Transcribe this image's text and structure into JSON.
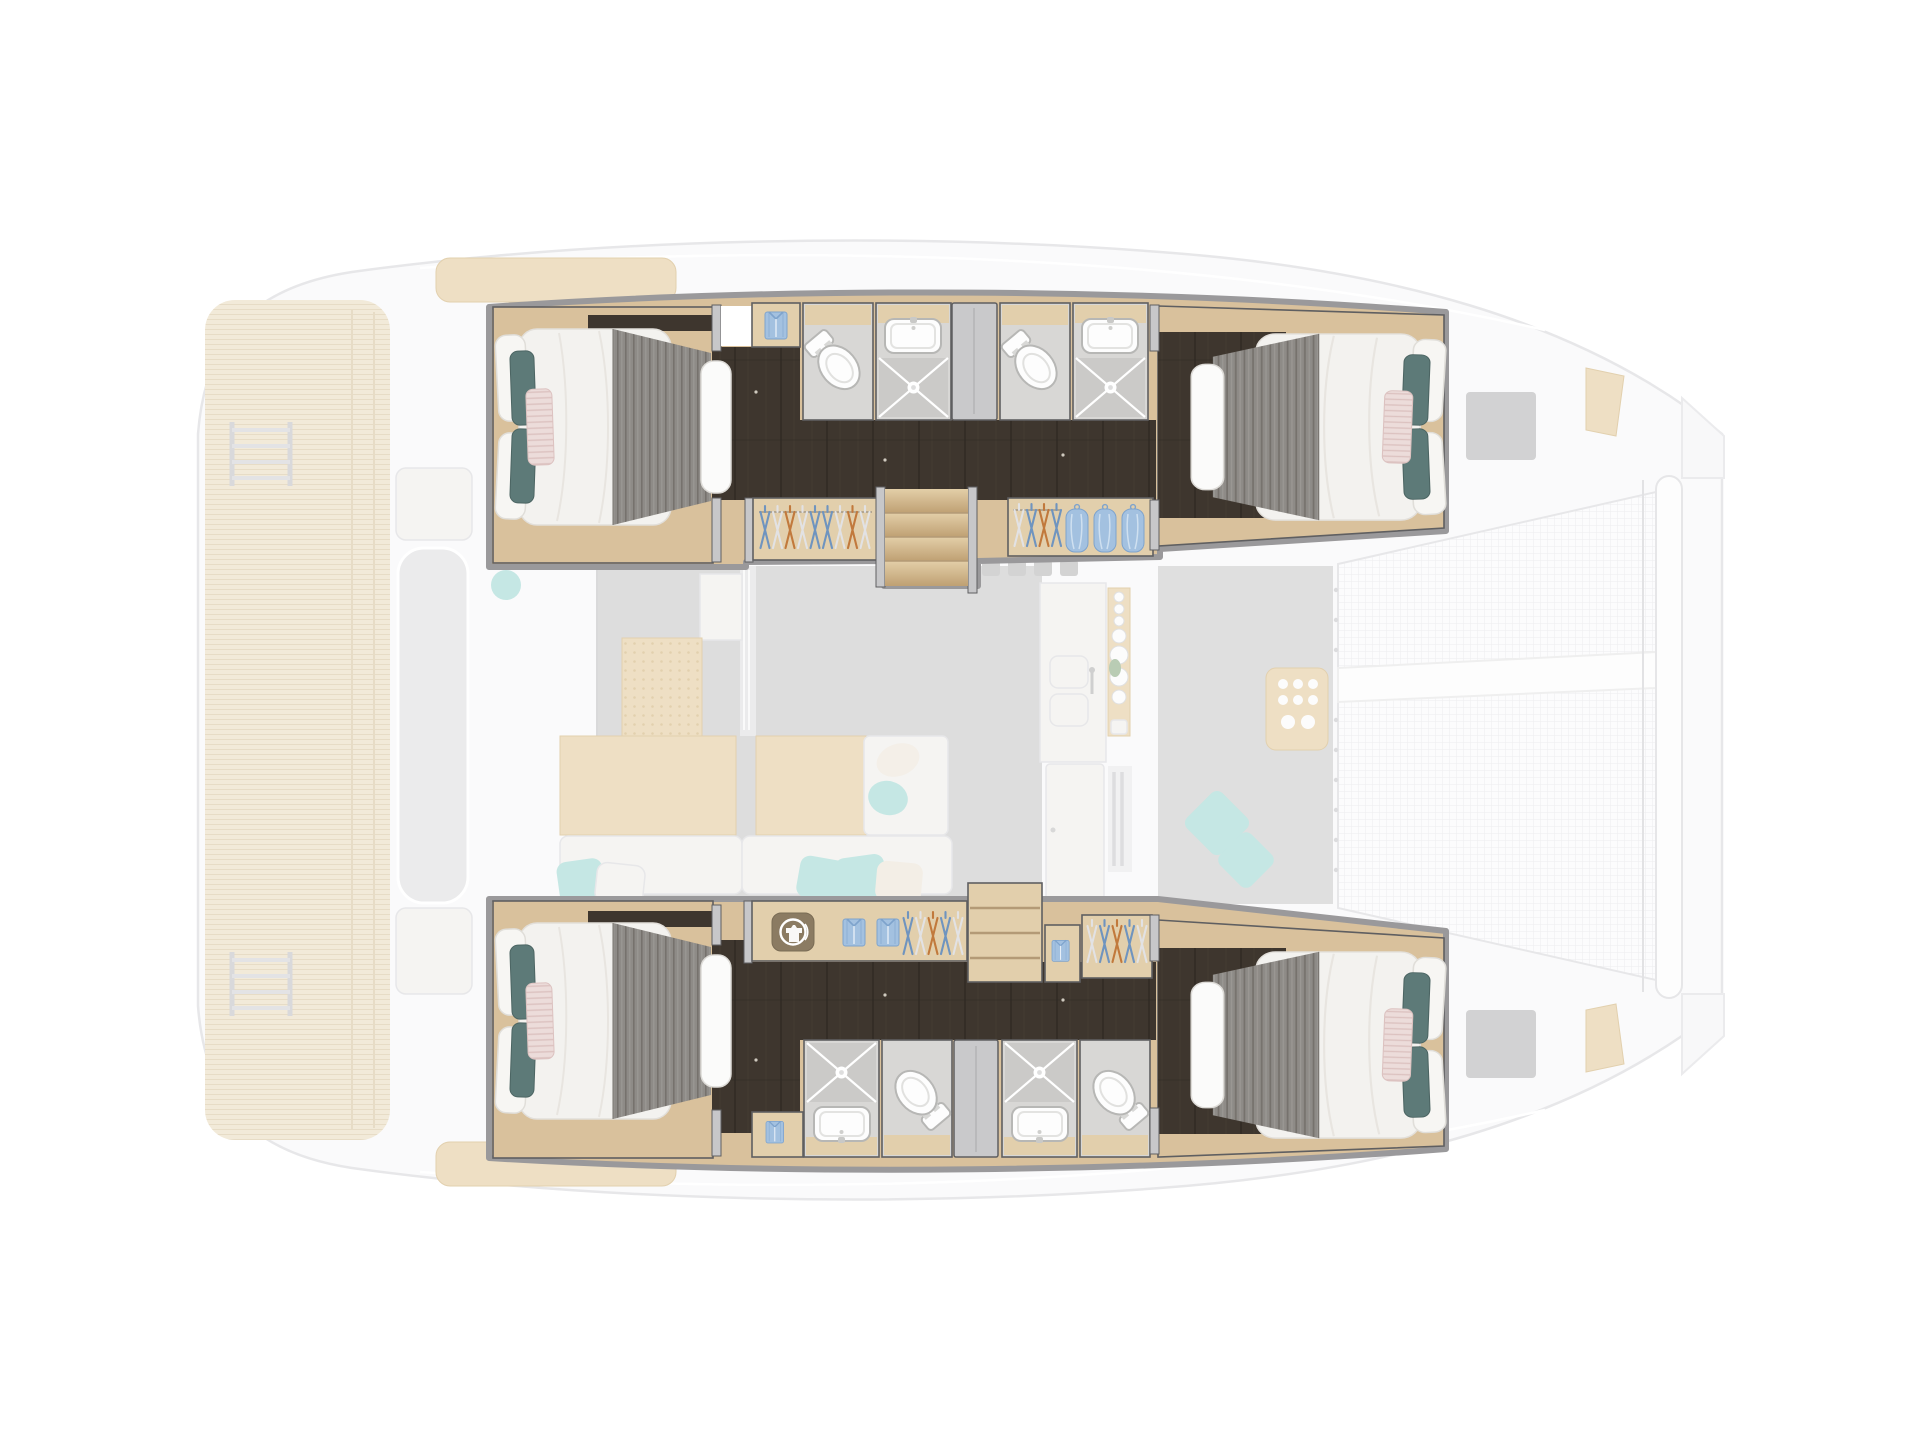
{
  "diagram": {
    "type": "yacht-floor-plan",
    "vessel": "sailing catamaran, top-down deck plan, bow to the right",
    "highlighted": "four hull double cabins, four head compartments with showers, wardrobes and companionway at full opacity",
    "ghosted": "aft swim platforms, cockpit, saloon, galley, forward cockpit, foredeck hatches and bow trampoline shown faded"
  },
  "counts": {
    "double_cabins": 4,
    "head_compartments": 4,
    "toilets": 4,
    "washbasins": 4,
    "shower_trays": 4,
    "wardrobes": 4,
    "folded_shirts": 5,
    "hanging_garments": 3,
    "companionway_steps": 4
  },
  "labels": {
    "plan": "Catamaran deck plan - four cabin layout",
    "port_hull": "Port hull accommodations (top)",
    "stbd_hull": "Starboard hull accommodations (bottom)",
    "port_aft_cabin": "Port aft double cabin, island bed head towards stern",
    "port_fwd_cabin": "Port forward double cabin, island bed head towards bow",
    "stbd_aft_cabin": "Starboard aft double cabin, island bed head towards stern",
    "stbd_fwd_cabin": "Starboard forward double cabin, island bed head towards bow",
    "head": "Guest head: toilet, washbasin and shower tray with light",
    "sliding_door": "Sliding door panel",
    "companionway": "Companionway steps down from saloon",
    "wardrobe": "Wardrobe with clothes hangers",
    "closet": "Locker with folded shirt",
    "desk": "Vanity desk with washing machine and folded shirts",
    "shelves": "Open shelving unit",
    "corridor": "Hull corridor, dark wood sole",
    "ghost_stern": "Stern teak platforms with swim ladders (ghosted)",
    "ghost_cockpit": "Aft cockpit bench and tables (ghosted)",
    "ghost_saloon": "Saloon sofa, daybed and sideboard (ghosted)",
    "ghost_galley": "Galley: 4-burner stove, double sink, fridge (ghosted)",
    "ghost_fwd_cockpit": "Forward cockpit lounge and console (ghosted)",
    "ghost_foredeck": "Foredeck hatches and anchor lockers (ghosted)",
    "ghost_trampoline": "Bow trampoline net with crossbeam (ghosted)"
  },
  "wardrobe_hangers": {
    "port_aft": [
      "blue",
      "white",
      "orange",
      "white",
      "blue",
      "blue",
      "white",
      "orange",
      "white"
    ],
    "port_fwd": [
      "white",
      "blue",
      "orange",
      "blue"
    ],
    "stbd_desk": [
      "blue",
      "white",
      "orange",
      "blue",
      "white"
    ],
    "stbd_fwd": [
      "white",
      "blue",
      "orange",
      "blue",
      "white"
    ]
  },
  "colors": {
    "silhouette": "#fafafb",
    "outline": "#e7e7e9",
    "wall": "#9a999b",
    "wallFill": "#c7c7c9",
    "wallDark": "#5f5f61",
    "wood": "#d9c19c",
    "woodLight": "#e2cfac",
    "woodTrim": "#b39a76",
    "floorDark": "#3e362e",
    "floorDarkLine": "#302a24",
    "floorDarkGrain": "#4a4138",
    "bathFloor": "#d8d7d5",
    "showerPan": "#cbcac8",
    "fixture": "#fdfdfd",
    "fixtureLine": "#b7b7b5",
    "doorGray": "#c9c9cb",
    "duvet": "#f3f2ef",
    "mattress": "#fbfbfa",
    "blanket": "#8e8b87",
    "blanketDark": "#76726d",
    "blanketLight": "#9b9894",
    "pillowWhite": "#f7f6f3",
    "pillowTeal": "#5d7a78",
    "pillowTealLine": "#4c6563",
    "pillowPink": "#ecdcda",
    "pinkStripe": "#dcc2c0",
    "hangerBlue": "#6f94bf",
    "hangerOrange": "#c1793c",
    "hangerWhite": "#e2e2e4",
    "hangerRail": "#b4a68e",
    "shirtBlue": "#a3c1e0",
    "shirtDark": "#7ea3cc",
    "washerBg": "#8b7b62",
    "stepLight": "#e3cfa8",
    "stepDark": "#bfa073",
    "ghostTeak": "#f2ead9",
    "ghostTeakLine": "#e7dcc6",
    "ghostFloor": "#d6d6d6",
    "ghostGray": "#ebebec",
    "ghostWhite": "#f5f4f2",
    "ghostWood": "#eedfc4",
    "ghostWoodLine": "#e2d0ae",
    "ghostAqua": "#c5e7e4",
    "ghostGreen": "#b9ccb4",
    "netBg": "#fcfcfd",
    "netLine": "#ededee",
    "lightDot": "#cfcabf"
  }
}
